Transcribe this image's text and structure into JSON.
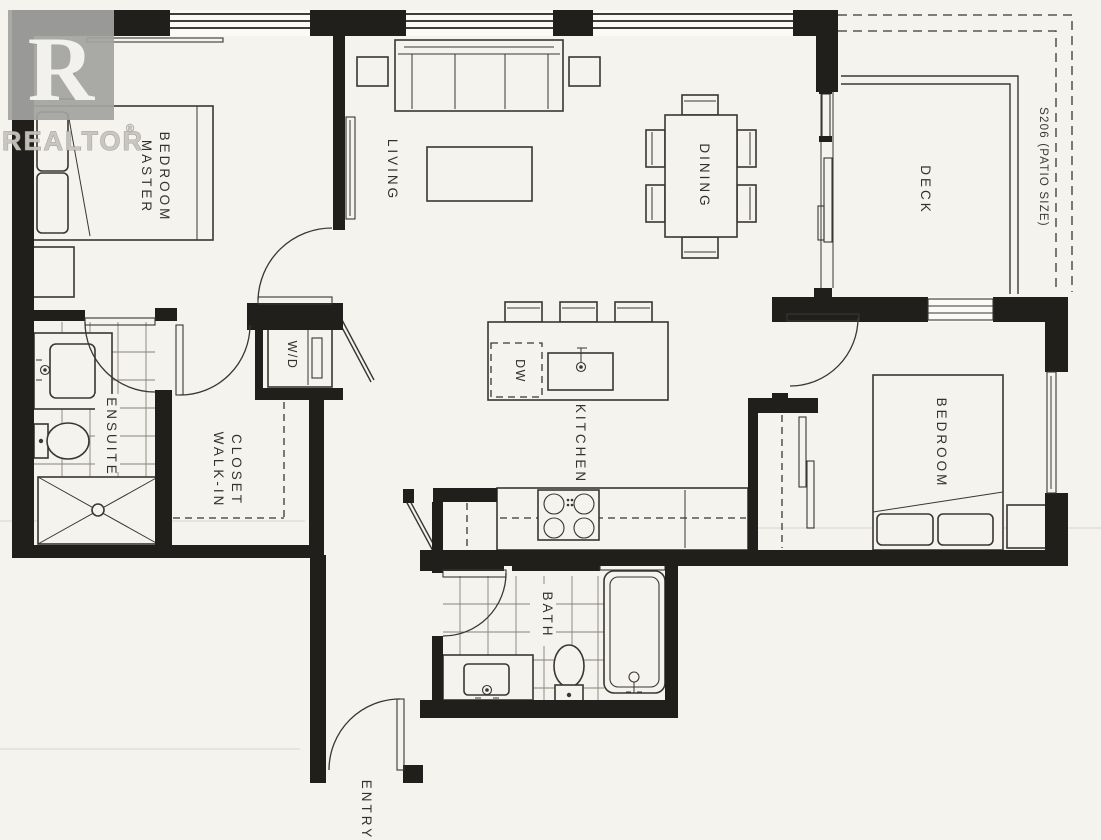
{
  "watermark": {
    "logo_letter": "R",
    "brand": "REALTOR",
    "registered": "®"
  },
  "plan": {
    "rooms": {
      "master_bedroom": {
        "line1": "MASTER",
        "line2": "BEDROOM"
      },
      "living": {
        "label": "LIVING"
      },
      "dining": {
        "label": "DINING"
      },
      "deck": {
        "label": "DECK"
      },
      "patio_note": {
        "label": "S206 (PATIO SIZE)"
      },
      "ensuite": {
        "label": "ENSUITE"
      },
      "walk_in_closet": {
        "line1": "WALK-IN",
        "line2": "CLOSET"
      },
      "laundry": {
        "label": "W/D"
      },
      "kitchen": {
        "label": "KITCHEN"
      },
      "dishwasher": {
        "label": "DW"
      },
      "bedroom": {
        "label": "BEDROOM"
      },
      "bath": {
        "label": "BATH"
      },
      "entry": {
        "label": "ENTRY"
      }
    },
    "colors": {
      "wall": "#211f1b",
      "ink": "#3a3732",
      "paper": "#f5f3ee"
    }
  }
}
